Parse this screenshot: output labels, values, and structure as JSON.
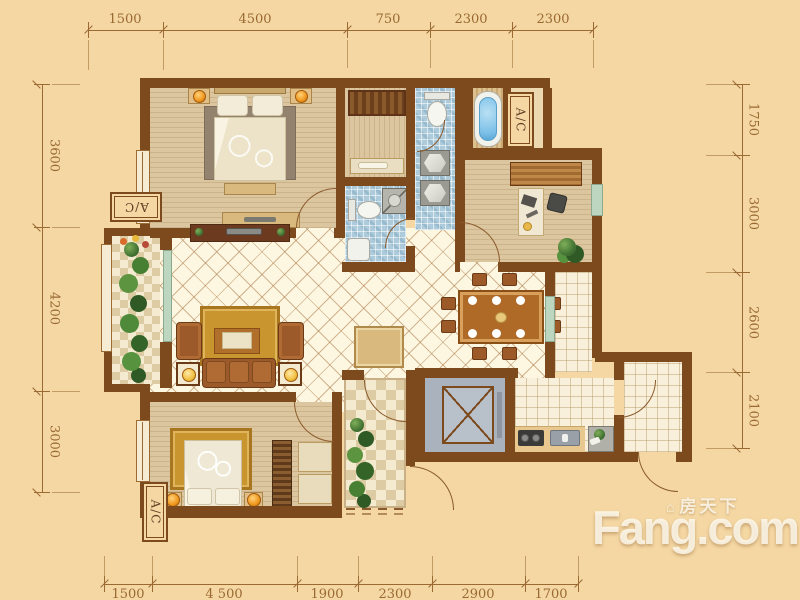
{
  "dims": {
    "top": [
      "1500",
      "4500",
      "750",
      "2300",
      "2300"
    ],
    "bottom": [
      "1500",
      "4 500",
      "1900",
      "2300",
      "2900",
      "1700"
    ],
    "left": [
      "3600",
      "4200",
      "3000"
    ],
    "right": [
      "1750",
      "3000",
      "2600",
      "2100"
    ]
  },
  "ac_label": "A/C",
  "watermark": {
    "brand": "Fang.com",
    "cn": "房天下",
    "icon": "⌂"
  },
  "palette": {
    "background": "#f4d7a3",
    "wall_brown": "#7c4a1c",
    "dimension_line": "#9b6a33",
    "floor_cream": "#fdf7e1",
    "mosaic_blue": "#adcbdb",
    "wood_tan": "#dcc6a0",
    "rug_gold": "#c9952e",
    "sofa_brown": "#9c5a28",
    "bath_water_blue": "#7cc0e8",
    "lamp_orange": "#f0971c",
    "plant_green": "#3f7031",
    "elevator_gray": "#aab3bd"
  }
}
